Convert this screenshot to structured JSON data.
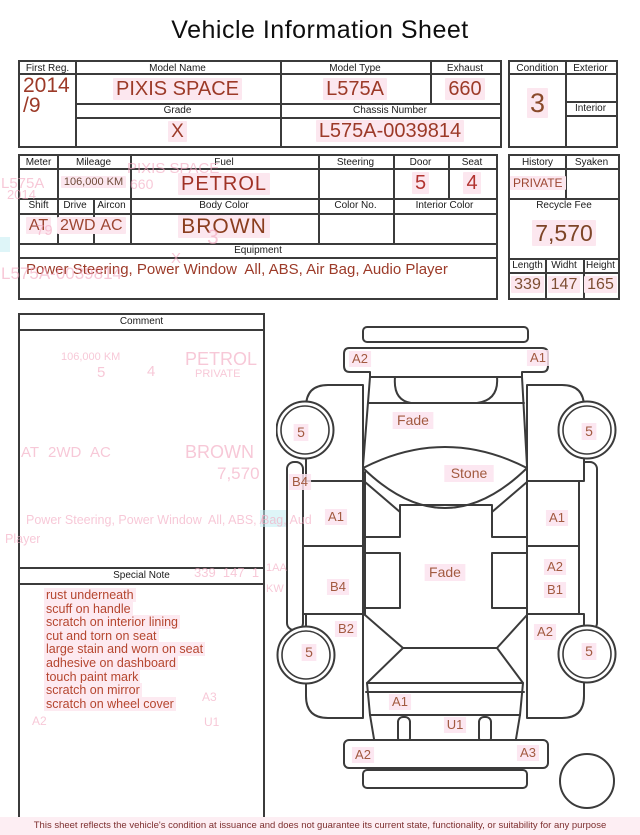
{
  "title": "Vehicle Information Sheet",
  "table1": {
    "first_reg_label": "First Reg.",
    "first_reg_value": "2014\n/9",
    "model_name_label": "Model Name",
    "model_name_value": "PIXIS SPACE",
    "model_type_label": "Model Type",
    "model_type_value": "L575A",
    "exhaust_label": "Exhaust",
    "exhaust_value": "660",
    "grade_label": "Grade",
    "grade_value": "X",
    "chassis_label": "Chassis Number",
    "chassis_value": "L575A-0039814"
  },
  "condition_box": {
    "condition_label": "Condition",
    "condition_value": "3",
    "exterior_label": "Exterior",
    "exterior_value": "",
    "interior_label": "Interior",
    "interior_value": ""
  },
  "table2": {
    "meter_label": "Meter",
    "meter_value": "",
    "mileage_label": "Mileage",
    "mileage_value": "106,000 KM",
    "fuel_label": "Fuel",
    "fuel_value": "PETROL",
    "steering_label": "Steering",
    "steering_value": "",
    "door_label": "Door",
    "door_value": "5",
    "seat_label": "Seat",
    "seat_value": "4",
    "shift_label": "Shift",
    "shift_value": "AT",
    "drive_label": "Drive",
    "drive_value": "2WD",
    "aircon_label": "Aircon",
    "aircon_value": "AC",
    "body_color_label": "Body Color",
    "body_color_value": "BROWN",
    "color_no_label": "Color No.",
    "color_no_value": "",
    "interior_color_label": "Interior Color",
    "interior_color_value": "",
    "equipment_label": "Equipment",
    "equipment_value": "Power Steering, Power Window  All, ABS, Air Bag, Audio Player"
  },
  "history_box": {
    "history_label": "History",
    "history_value": "PRIVATE",
    "syaken_label": "Syaken",
    "syaken_value": "",
    "recycle_label": "Recycle Fee",
    "recycle_value": "7,570",
    "length_label": "Length",
    "length_value": "339",
    "width_label": "Widht",
    "width_value": "147",
    "height_label": "Height",
    "height_value": "165"
  },
  "comment": {
    "header": "Comment"
  },
  "special_note": {
    "header": "Special Note",
    "items": [
      "rust underneath",
      "scuff on handle",
      "scratch on interior lining",
      "cut and torn on seat",
      "large stain and worn on seat",
      "adhesive on dashboard",
      "touch paint mark",
      "scratch on mirror",
      "scratch on wheel cover"
    ]
  },
  "diagram": {
    "labels": [
      {
        "t": "A2",
        "x": 84,
        "y": 48,
        "s": 13
      },
      {
        "t": "A1",
        "x": 262,
        "y": 47,
        "s": 13
      },
      {
        "t": "Fade",
        "x": 137,
        "y": 110,
        "s": 14
      },
      {
        "t": "Stone",
        "x": 193,
        "y": 163,
        "s": 14
      },
      {
        "t": "5",
        "x": 25,
        "y": 122,
        "s": 14
      },
      {
        "t": "5",
        "x": 313,
        "y": 121,
        "s": 14
      },
      {
        "t": "B4",
        "x": 24,
        "y": 171,
        "s": 13
      },
      {
        "t": "A1",
        "x": 60,
        "y": 206,
        "s": 13
      },
      {
        "t": "A1",
        "x": 281,
        "y": 207,
        "s": 13
      },
      {
        "t": "B4",
        "x": 62,
        "y": 276,
        "s": 13
      },
      {
        "t": "A2",
        "x": 279,
        "y": 256,
        "s": 13
      },
      {
        "t": "B1",
        "x": 279,
        "y": 279,
        "s": 13
      },
      {
        "t": "Fade",
        "x": 169,
        "y": 262,
        "s": 14
      },
      {
        "t": "B2",
        "x": 70,
        "y": 318,
        "s": 13
      },
      {
        "t": "A2",
        "x": 269,
        "y": 321,
        "s": 13
      },
      {
        "t": "5",
        "x": 33,
        "y": 342,
        "s": 14
      },
      {
        "t": "5",
        "x": 313,
        "y": 341,
        "s": 14
      },
      {
        "t": "A1",
        "x": 124,
        "y": 391,
        "s": 13
      },
      {
        "t": "U1",
        "x": 179,
        "y": 414,
        "s": 13
      },
      {
        "t": "A2",
        "x": 87,
        "y": 444,
        "s": 13
      },
      {
        "t": "A3",
        "x": 252,
        "y": 442,
        "s": 13
      }
    ]
  },
  "ghosts": [
    {
      "text": "L575A",
      "x": 1,
      "y": 175,
      "s": 15
    },
    {
      "text": "2014",
      "x": 7,
      "y": 187,
      "s": 13
    },
    {
      "text": "PIXIS SPACE",
      "x": 127,
      "y": 160,
      "s": 15
    },
    {
      "text": "660",
      "x": 130,
      "y": 176,
      "s": 14
    },
    {
      "text": "79",
      "x": 36,
      "y": 222,
      "s": 15
    },
    {
      "text": "3",
      "x": 207,
      "y": 226,
      "s": 21
    },
    {
      "text": "X",
      "x": 171,
      "y": 250,
      "s": 15
    },
    {
      "text": "L575A-0039814",
      "x": 1,
      "y": 264,
      "s": 17
    },
    {
      "text": "106,000 KM",
      "x": 61,
      "y": 351,
      "s": 11
    },
    {
      "text": "5",
      "x": 97,
      "y": 364,
      "s": 15
    },
    {
      "text": "4",
      "x": 147,
      "y": 363,
      "s": 15
    },
    {
      "text": "PETROL",
      "x": 185,
      "y": 349,
      "s": 18
    },
    {
      "text": "PRIVATE",
      "x": 195,
      "y": 368,
      "s": 11
    },
    {
      "text": "AT",
      "x": 21,
      "y": 444,
      "s": 15
    },
    {
      "text": "2WD",
      "x": 48,
      "y": 444,
      "s": 15
    },
    {
      "text": "AC",
      "x": 90,
      "y": 444,
      "s": 15
    },
    {
      "text": "BROWN",
      "x": 185,
      "y": 442,
      "s": 18
    },
    {
      "text": "7,570",
      "x": 217,
      "y": 464,
      "s": 17
    },
    {
      "text": "Power Steering, Power Window  All, ABS, Air B",
      "x": 26,
      "y": 513,
      "s": 12.5,
      "w": 238
    },
    {
      "text": "Player",
      "x": 5,
      "y": 532,
      "s": 12.5
    },
    {
      "text": "339  147  1",
      "x": 194,
      "y": 565,
      "s": 13,
      "w": 70
    },
    {
      "text": "A3",
      "x": 202,
      "y": 690,
      "s": 12
    },
    {
      "text": "A2",
      "x": 32,
      "y": 714,
      "s": 12
    },
    {
      "text": "U1",
      "x": 204,
      "y": 715,
      "s": 12
    },
    {
      "text": "Bag, Aud",
      "x": 261,
      "y": 513,
      "s": 12.5
    },
    {
      "text": "1AA",
      "x": 266,
      "y": 562,
      "s": 11
    },
    {
      "text": "KW",
      "x": 266,
      "y": 583,
      "s": 11
    }
  ],
  "ghost_patches": [
    {
      "x": 260,
      "y": 510,
      "w": 26,
      "h": 17
    },
    {
      "x": 0,
      "y": 237,
      "w": 10,
      "h": 15
    }
  ],
  "disclaimer": "This sheet reflects the vehicle's condition at issuance and does not guarantee its current state, functionality, or suitability for any purpose",
  "colors": {
    "value_red": "#9c3a28",
    "digit_red": "#b23430",
    "note_red": "#b5462f",
    "label_brown": "#a25a40",
    "line": "#3b3b3b",
    "highlight": "#fce7ef"
  }
}
